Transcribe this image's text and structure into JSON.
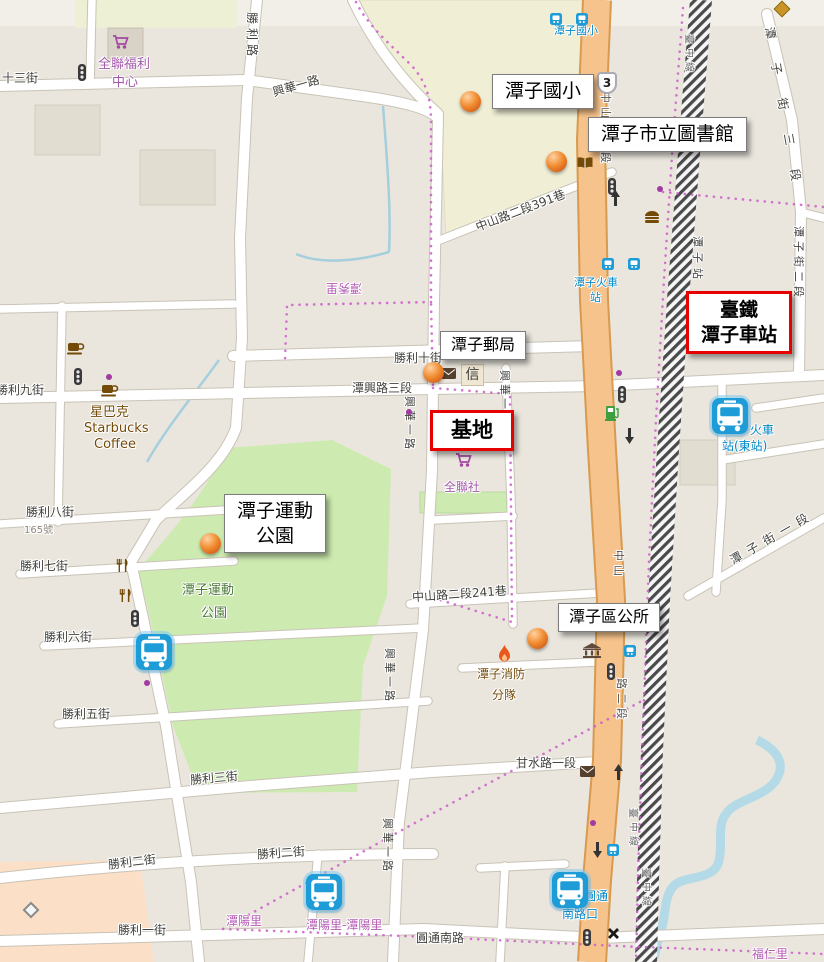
{
  "colors": {
    "accent_red": "#e60000",
    "road_orange": "#f6c38c",
    "park_green": "#cdebb0",
    "school_beige": "#f0efd6",
    "water_blue": "#abd4e1",
    "boundary_pink": "#c75fc7",
    "transit_blue": "#0087c5",
    "poi_brown": "#734a08",
    "poi_purple": "#a259a8"
  },
  "callouts": {
    "school": "潭子國小",
    "library": "潭子市立圖書館",
    "station_line1": "臺鐵",
    "station_line2": "潭子車站",
    "post_office": "潭子郵局",
    "site": "基地",
    "sports_park_line1": "潭子運動",
    "sports_park_line2": "公園",
    "district_office": "潭子區公所"
  },
  "roads": {
    "shengli_rd": "勝利路",
    "st_13": "十三街",
    "xinghua_1st": "興華一路",
    "zhongshan_391": "中山路二段391巷",
    "tanzi_st_3": "潭子街三段",
    "tanzi_st_2": "潭子街二段",
    "tanzi_st_1": "潭子街一段",
    "shengli_10": "勝利十街",
    "shengli_9": "勝利九街",
    "shengli_8": "勝利八街",
    "shengli_7": "勝利七街",
    "shengli_6": "勝利六街",
    "shengli_5": "勝利五街",
    "shengli_3": "勝利三街",
    "shengli_2": "勝利二街",
    "shengli_1": "勝利一街",
    "tanxing_3": "潭興路三段",
    "zhongshan_241": "中山路二段241巷",
    "ganshui_1": "甘水路一段",
    "yuantong_s": "圓通南路",
    "zhongshan_1": "中山路一段",
    "zhongshan_2_part1": "中山",
    "zhongshan_2_part2": "路二段",
    "route_3": "3",
    "house_165": "165號"
  },
  "pois": {
    "pxmart_line1": "全聯福利",
    "pxmart_line2": "中心",
    "pxmart_2": "全聯社",
    "starbucks_line1": "星巴克",
    "starbucks_line2": "Starbucks",
    "starbucks_line3": "Coffee",
    "park_line1": "潭子運動",
    "park_line2": "公園",
    "fire_line1": "潭子消防",
    "fire_line2": "分隊",
    "letter": "信"
  },
  "transit": {
    "stop_school": "潭子國小",
    "stop_station_line1": "潭子火車",
    "stop_station_line2": "站",
    "stop_east_line1": "火車",
    "stop_east_line2": "站(東站)",
    "stop_yuantong_line1": "圓通",
    "stop_yuantong_line2": "南路口",
    "rail_station": "潭子站",
    "rail_line": "臺中線"
  },
  "boundaries": {
    "tanyang": "潭陽里",
    "tanyang_pair": "潭陽里-潭陽里",
    "furen": "福仁里",
    "tanxiu": "潭秀里"
  }
}
